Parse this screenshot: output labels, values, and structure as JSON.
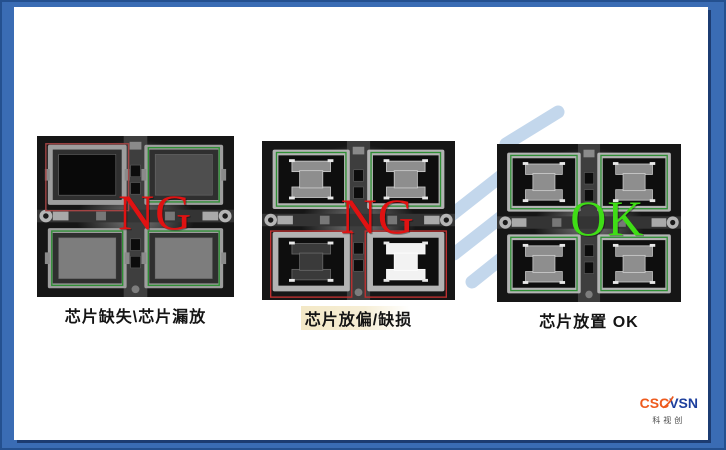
{
  "slide": {
    "background_color": "#ffffff",
    "frame_color": "#3a6cb4",
    "frame_edge_color": "#24508f",
    "sheet_shadow_color": "#1c3c72"
  },
  "watermark": {
    "name": "light-blue-swoosh",
    "color": "#c3d7ec"
  },
  "panels": [
    {
      "name": "chip-missing",
      "label": "NG",
      "label_color": "#e01212",
      "caption": "芯片缺失\\芯片漏放",
      "caption_highlight": false,
      "style": "open_socket",
      "sockets": [
        {
          "pos": "top-left",
          "outline": "#a34444",
          "box": "outset",
          "chip": "empty"
        },
        {
          "pos": "top-right",
          "outline": "#2f8f35",
          "box": "inset",
          "chip": "dim_plate"
        },
        {
          "pos": "bottom-left",
          "outline": "#2f8f35",
          "box": "inset",
          "chip": "plate"
        },
        {
          "pos": "bottom-right",
          "outline": "#2f8f35",
          "box": "inset",
          "chip": "plate"
        }
      ]
    },
    {
      "name": "chip-misplaced-or-damaged",
      "label": "NG",
      "label_color": "#e01212",
      "caption": "芯片放偏/缺损",
      "caption_highlight": true,
      "style": "dogbone",
      "sockets": [
        {
          "pos": "top-left",
          "outline": "#2f8f35",
          "box": "inset",
          "chip": "dogbone"
        },
        {
          "pos": "top-right",
          "outline": "#2f8f35",
          "box": "inset",
          "chip": "dogbone"
        },
        {
          "pos": "bottom-left",
          "outline": "#c03030",
          "box": "outset",
          "chip": "dogbone_dark"
        },
        {
          "pos": "bottom-right",
          "outline": "#c03030",
          "box": "outset",
          "chip": "dogbone_white"
        }
      ]
    },
    {
      "name": "chip-placed-ok",
      "label": "OK",
      "label_color": "#3fdd16",
      "caption": "芯片放置 OK",
      "caption_highlight": false,
      "style": "dogbone",
      "sockets": [
        {
          "pos": "top-left",
          "outline": "#2f8f35",
          "box": "inset",
          "chip": "dogbone"
        },
        {
          "pos": "top-right",
          "outline": "#2f8f35",
          "box": "inset",
          "chip": "dogbone"
        },
        {
          "pos": "bottom-left",
          "outline": "#2f8f35",
          "box": "inset",
          "chip": "dogbone"
        },
        {
          "pos": "bottom-right",
          "outline": "#2f8f35",
          "box": "inset",
          "chip": "dogbone"
        }
      ]
    }
  ],
  "logo": {
    "brand_left": "CSC",
    "brand_right": "VSN",
    "tagline": "科视创",
    "left_color": "#ee5a1d",
    "right_color": "#1d3f9d",
    "tagline_color": "#4a4a4a"
  }
}
